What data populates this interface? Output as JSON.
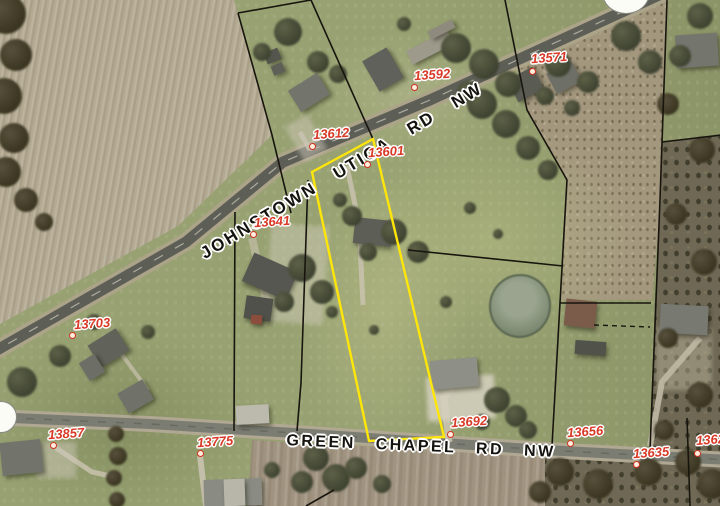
{
  "map": {
    "type": "county-auditor-aerial-parcel-map",
    "highlight_color": "#ffe60a",
    "parcel_label_color": "#d93a28",
    "road_label_color": "#15130e",
    "roads": [
      {
        "name": "JOHNSTOWN UTICA RD NW",
        "x": 342,
        "y": 171,
        "angle": -31,
        "font_size": 17,
        "word_spacing": 15
      },
      {
        "name": "GREEN CHAPEL RD NW",
        "x": 421,
        "y": 447,
        "angle": 2.5,
        "font_size": 16,
        "word_spacing": 13
      }
    ],
    "parcel_labels": [
      {
        "number": "13592",
        "text_x": 414,
        "text_y": 67,
        "dot_x": 414,
        "dot_y": 87
      },
      {
        "number": "13571",
        "text_x": 531,
        "text_y": 50,
        "dot_x": 532,
        "dot_y": 71
      },
      {
        "number": "13612",
        "text_x": 313,
        "text_y": 126,
        "dot_x": 312,
        "dot_y": 146
      },
      {
        "number": "13601",
        "text_x": 368,
        "text_y": 144,
        "dot_x": 367,
        "dot_y": 164
      },
      {
        "number": "13641",
        "text_x": 254,
        "text_y": 214,
        "dot_x": 253,
        "dot_y": 234
      },
      {
        "number": "13703",
        "text_x": 74,
        "text_y": 316,
        "dot_x": 72,
        "dot_y": 335
      },
      {
        "number": "13857",
        "text_x": 48,
        "text_y": 426,
        "dot_x": 53,
        "dot_y": 445
      },
      {
        "number": "13775",
        "text_x": 197,
        "text_y": 434,
        "dot_x": 200,
        "dot_y": 453
      },
      {
        "number": "13692",
        "text_x": 451,
        "text_y": 414,
        "dot_x": 450,
        "dot_y": 434
      },
      {
        "number": "13656",
        "text_x": 567,
        "text_y": 424,
        "dot_x": 570,
        "dot_y": 443
      },
      {
        "number": "13635",
        "text_x": 633,
        "text_y": 445,
        "dot_x": 636,
        "dot_y": 464
      },
      {
        "number": "1362",
        "text_x": 696,
        "text_y": 432,
        "dot_x": 697,
        "dot_y": 453
      }
    ]
  }
}
